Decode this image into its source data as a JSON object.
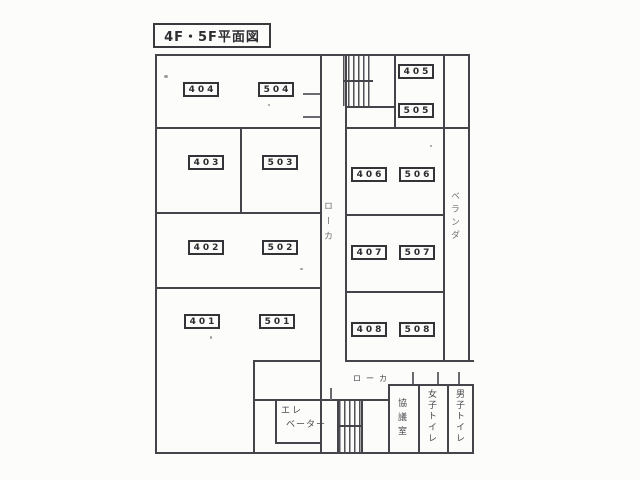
{
  "title": "4F・5F平面図",
  "plan": {
    "rooms": [
      {
        "f4": "404",
        "f5": "504"
      },
      {
        "f4": "403",
        "f5": "503"
      },
      {
        "f4": "402",
        "f5": "502"
      },
      {
        "f4": "401",
        "f5": "501"
      },
      {
        "f4": "405",
        "f5": "505"
      },
      {
        "f4": "406",
        "f5": "506"
      },
      {
        "f4": "407",
        "f5": "507"
      },
      {
        "f4": "408",
        "f5": "508"
      }
    ],
    "labels": {
      "corridor_main": "ローカ",
      "corridor_bottom": "ローカ",
      "veranda": "ベランダ",
      "elevator_line1": "エレ",
      "elevator_line2": "ベーター",
      "meeting_room": "協議室",
      "womens_toilet": "女子トイレ",
      "mens_toilet": "男子トイレ"
    },
    "colors": {
      "line": "#44444a",
      "paper": "#fcfcfa"
    }
  }
}
